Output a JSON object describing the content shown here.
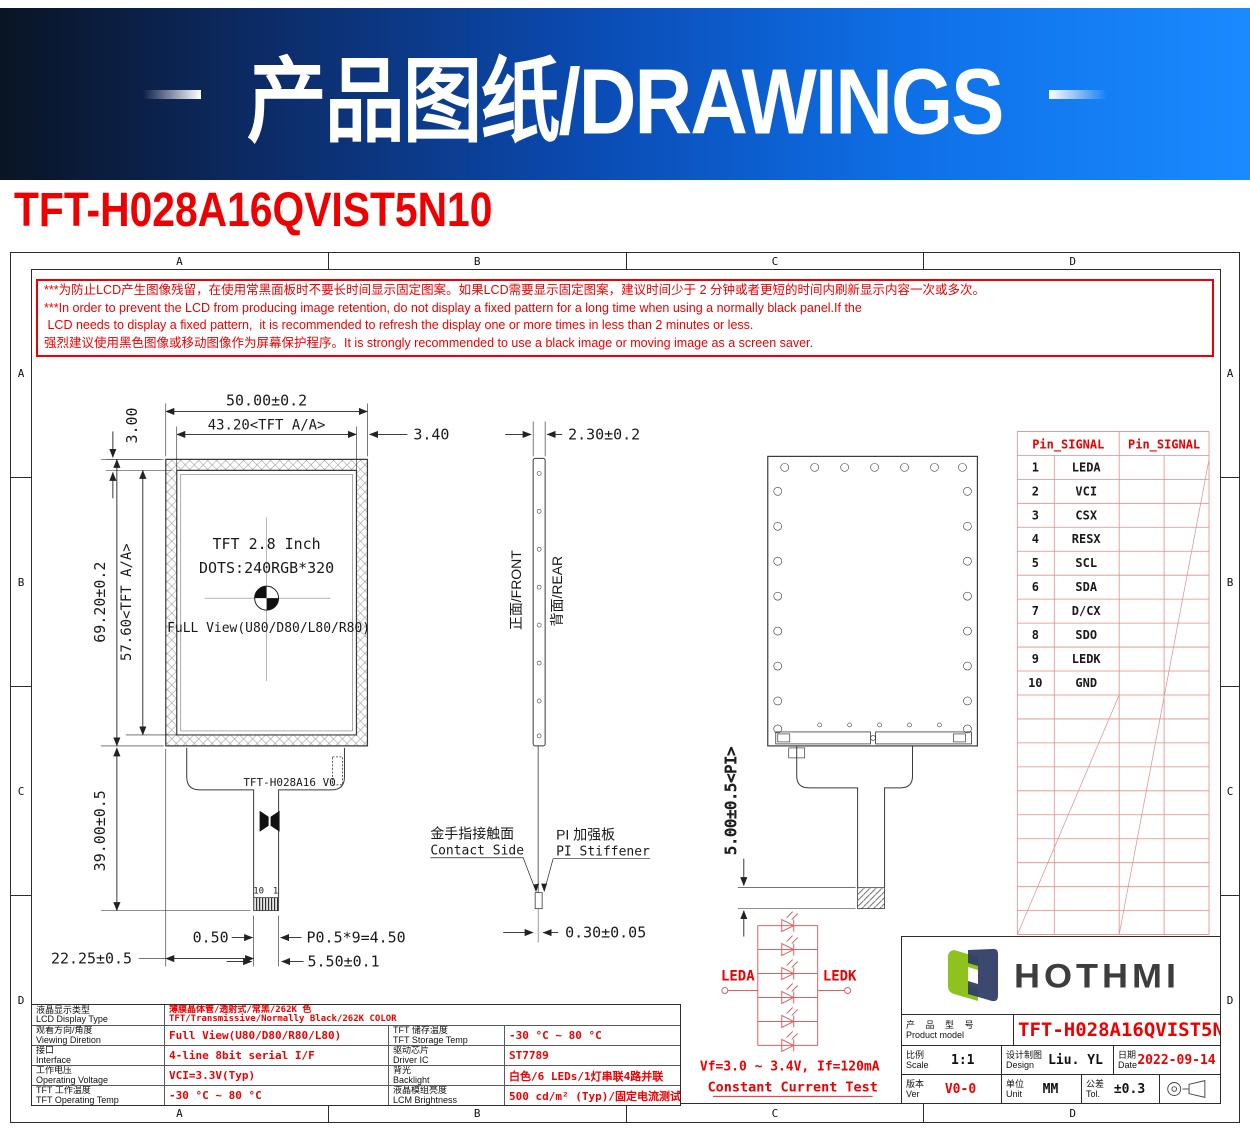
{
  "banner": {
    "title": "产品图纸/DRAWINGS"
  },
  "page_title": "TFT-H028A16QVIST5N10",
  "frame": {
    "cols": [
      "A",
      "B",
      "C",
      "D"
    ],
    "rows": [
      "A",
      "B",
      "C",
      "D"
    ]
  },
  "warning": {
    "lines": [
      "***为防止LCD产生图像残留，在使用常黑面板时不要长时间显示固定图案。如果LCD需要显示固定图案，建议时间少于 2 分钟或者更短的时间内刷新显示内容一次或多次。",
      "***In order to prevent the LCD from producing image retention, do not display a fixed pattern for a long time when using a normally black panel.If the",
      " LCD needs to display a fixed pattern,  it is recommended to refresh the display one or more times in less than 2 minutes or less.",
      "强烈建议使用黑色图像或移动图像作为屏幕保护程序。It is strongly recommended to use a black image or moving image as a screen saver."
    ]
  },
  "front_view": {
    "dim_overall_width": "50.00±0.2",
    "dim_aa_width": "43.20<TFT A/A>",
    "dim_right_margin": "3.40",
    "dim_top_margin": "3.00",
    "dim_overall_height": "69.20±0.2",
    "dim_aa_height": "57.60<TFT A/A>",
    "dim_fpc_length": "39.00±0.5",
    "dim_fpc_offset": "22.25±0.5",
    "dim_finger_margin": "0.50",
    "dim_pitch": "P0.5*9=4.50",
    "dim_finger_width": "5.50±0.1",
    "label_size": "TFT 2.8 Inch",
    "label_dots": "DOTS:240RGB*320",
    "label_view": "FuLL View(U80/D80/L80/R80)",
    "fpc_label": "TFT-H028A16 V0",
    "pin_last": "10",
    "pin_first": "1"
  },
  "side_view": {
    "dim_thickness": "2.30±0.2",
    "front_label": "正面/FRONT",
    "rear_label": "背面/REAR",
    "contact_cn": "金手指接触面",
    "contact_en": "Contact Side",
    "stiffener_cn": "PI 加强板",
    "stiffener_en": "PI Stiffener",
    "dim_fpc_thickness": "0.30±0.05"
  },
  "rear_view": {
    "dim_stiffener": "5.00±0.5<PI>"
  },
  "pin_table": {
    "header_left": "Pin_SIGNAL",
    "header_right": "Pin_SIGNAL",
    "pins": [
      {
        "no": "1",
        "signal": "LEDA"
      },
      {
        "no": "2",
        "signal": "VCI"
      },
      {
        "no": "3",
        "signal": "CSX"
      },
      {
        "no": "4",
        "signal": "RESX"
      },
      {
        "no": "5",
        "signal": "SCL"
      },
      {
        "no": "6",
        "signal": "SDA"
      },
      {
        "no": "7",
        "signal": "D/CX"
      },
      {
        "no": "8",
        "signal": "SDO"
      },
      {
        "no": "9",
        "signal": "LEDK"
      },
      {
        "no": "10",
        "signal": "GND"
      }
    ]
  },
  "led_circuit": {
    "anode": "LEDA",
    "cathode": "LEDK",
    "spec": "Vf=3.0 ~ 3.4V, If=120mA",
    "test": "Constant Current Test"
  },
  "spec_table": {
    "row1": {
      "label_cn": "液晶显示类型",
      "label_en": "LCD Display Type",
      "value_cn": "薄膜晶体管/透射式/常黑/262K 色",
      "value_en": "TFT/Transmissive/Normally Black/262K COLOR"
    },
    "rows": [
      {
        "left_cn": "观看方向/角度",
        "left_en": "Viewing Diretion",
        "left_val": "Full View(U80/D80/R80/L80)",
        "right_cn": "TFT 储存温度",
        "right_en": "TFT Storage Temp",
        "right_val": "-30 °C ~ 80 °C"
      },
      {
        "left_cn": "接口",
        "left_en": "Interface",
        "left_val": "4-line 8bit serial I/F",
        "right_cn": "驱动芯片",
        "right_en": "Driver IC",
        "right_val": "ST7789"
      },
      {
        "left_cn": "工作电压",
        "left_en": "Operating Voltage",
        "left_val": "VCI=3.3V(Typ)",
        "right_cn": "背光",
        "right_en": "Backlight",
        "right_val": "白色/6 LEDs/1灯串联4路并联"
      },
      {
        "left_cn": "TFT 工作温度",
        "left_en": "TFT Operating Temp",
        "left_val": "-30 °C ~ 80 °C",
        "right_cn": "液晶模组亮度",
        "right_en": "LCM Brightness",
        "right_val": "500 cd/m² (Typ)/固定电流测试"
      }
    ]
  },
  "title_block": {
    "logo_text": "HOTHMI",
    "product_cn": "产 品 型 号",
    "product_en": "Product model",
    "product_val": "TFT-H028A16QVIST5N10",
    "scale_cn": "比例",
    "scale_en": "Scale",
    "scale_val": "1:1",
    "design_cn": "设计制图",
    "design_en": "Design",
    "design_val": "Liu. YL",
    "date_cn": "日期",
    "date_en": "Date",
    "date_val": "2022-09-14",
    "ver_cn": "版本",
    "ver_en": "Ver",
    "ver_val": "V0-0",
    "unit_cn": "单位",
    "unit_en": "Unit",
    "unit_val": "MM",
    "tol_cn": "公差",
    "tol_en": "Tol.",
    "tol_val": "±0.3"
  },
  "colors": {
    "accent_red": "#ef0000",
    "banner_blue": "#0e6fe6",
    "logo_green": "#8dc21f",
    "logo_navy": "#2e3a66"
  }
}
